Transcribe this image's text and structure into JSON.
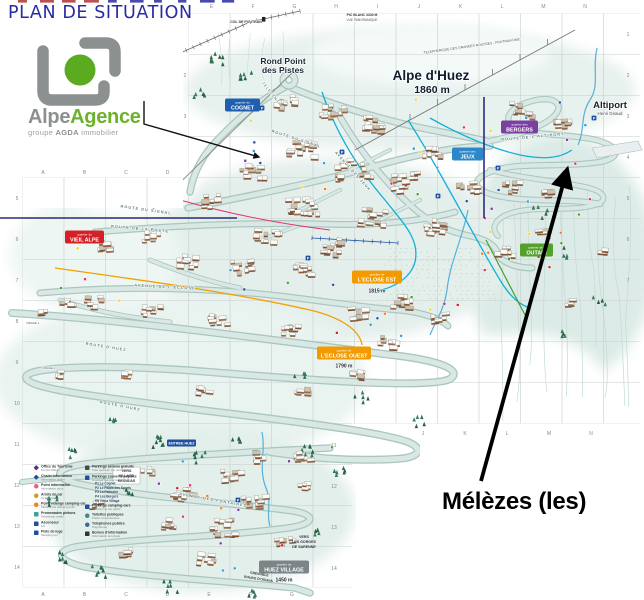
{
  "title": "PLAN DE SITUATION",
  "logo": {
    "brand_gray": "Alpe",
    "brand_green": "Agence",
    "sub_1": "groupe ",
    "sub_2": "AGDA",
    "sub_3": " immobilier"
  },
  "callout": {
    "label": "Mélèzes (les)"
  },
  "resort": {
    "name": "Alpe d'Huez",
    "altitude": "1860 m",
    "rond_point_line1": "Rond Point",
    "rond_point_line2": "des Pistes",
    "altiport": "Altiport",
    "altiport_sub": "Henri Giraud"
  },
  "quartiers": {
    "cognet": {
      "prefix": "quartier du",
      "name": "COGNET",
      "color": "#1f5fae"
    },
    "jeux": {
      "prefix": "quartier des",
      "name": "JEUX",
      "color": "#2b87c8"
    },
    "bergers": {
      "prefix": "quartier des",
      "name": "BERGERS",
      "color": "#7b3fa0"
    },
    "vieil_alpe": {
      "prefix": "quartier du",
      "name": "VIEIL ALPE",
      "color": "#d42027"
    },
    "outari": {
      "prefix": "quartier de l'",
      "name": "OUTARI",
      "color": "#55a02c"
    },
    "eclose_est": {
      "prefix": "quartier de",
      "name": "L'ECLOSE EST",
      "color": "#f29a00",
      "altitude": "1815 m"
    },
    "eclose_ouest": {
      "prefix": "quartier de",
      "name": "L'ECLOSE OUEST",
      "color": "#f29a00",
      "altitude": "1790 m"
    },
    "huez_village": {
      "prefix": "quartier de",
      "name": "HUEZ VILLAGE",
      "color": "#7d8487",
      "altitude": "1450 m"
    }
  },
  "places": {
    "col_de_poutran": "COL DE POUTRAN",
    "pic_blanc_line1": "PIC BLANC 3330 M",
    "pic_blanc_line2": "VUE PANORAMIQUE",
    "dmc": "TELEPHERIQUE DES GRANDES ROUSSES - POUTRAN DMC",
    "telecentre": "TELECENTRE",
    "vers_villard_1": "VERS",
    "vers_villard_2": "VILLARD",
    "vers_villard_3": "RECULAS",
    "vers_gorges_1": "VERS",
    "vers_gorges_2": "LES GORGES",
    "vers_gorges_3": "DE SARENNE",
    "grenoble_1": "GRENOBLE",
    "grenoble_2": "BOURG D'OISANS",
    "entree_huez": "ENTREE HUEZ",
    "virage_1": "VIRAGE 1",
    "virage_2": "VIRAGE 2"
  },
  "roads": {
    "signal": "ROUTE DU SIGNAL",
    "signal2": "ROUTE DU SIGNAL",
    "poste": "ROUTE DE LA POSTE",
    "eclose": "AVENUE DE L'ECLOSE",
    "huez1": "ROUTE D'HUEZ",
    "huez2": "ROUTE D'HUEZ",
    "jeux": "AVENUE DES JEUX",
    "altiport": "ROUTE DE L'ALTIPORT",
    "fontaines": "AVENUE DES FONTAINES"
  },
  "icons": {
    "parking": "P"
  },
  "grid": {
    "top_letters": [
      "E",
      "F",
      "G",
      "H",
      "I",
      "J",
      "K",
      "L",
      "M",
      "N"
    ],
    "mid_letters": [
      "A",
      "B",
      "C",
      "D"
    ],
    "bottom_letters": [
      "A",
      "B",
      "C",
      "D",
      "E",
      "F",
      "G"
    ],
    "bottom_right_letters": [
      "J",
      "K",
      "L",
      "M",
      "N"
    ],
    "right_numbers": [
      "1",
      "2",
      "3",
      "4",
      "5",
      "6",
      "7"
    ],
    "left_numbers": [
      "5",
      "6",
      "7",
      "8",
      "9",
      "10",
      "11",
      "12",
      "13",
      "14"
    ],
    "inner_left_numbers": [
      "2",
      "3"
    ],
    "inner_right_numbers": [
      "11",
      "12",
      "13",
      "14"
    ]
  },
  "legend": {
    "left": [
      {
        "fr": "Office du Tourisme",
        "en": "Tourist Office",
        "color": "#5a2d82",
        "shape": "diamond"
      },
      {
        "fr": "Chalet Information",
        "en": "Information chalet",
        "color": "#1f4fa0",
        "shape": "diamond"
      },
      {
        "fr": "Point Information",
        "en": "Information point",
        "color": "#e8608a",
        "shape": "circle"
      },
      {
        "fr": "Arrêts de car",
        "en": "Coach stops",
        "color": "#c8a020",
        "shape": "circle"
      },
      {
        "fr": "Point vidange camping-car",
        "en": "Motorhome draining point",
        "color": "#f08020",
        "shape": "circle"
      },
      {
        "fr": "Promenades piétons",
        "en": "Pedestrian walks",
        "color": "#3fa0a0",
        "shape": "square"
      },
      {
        "fr": "Ascenseur",
        "en": "Lift",
        "color": "#1f4fa0",
        "shape": "square"
      },
      {
        "fr": "Piste de luge",
        "en": "Sledging run",
        "color": "#1f4fa0",
        "shape": "square"
      }
    ],
    "right": [
      {
        "fr": "Parkings aériens gratuits",
        "en": "Free open-air car parks",
        "color": "#444c52",
        "shape": "square"
      },
      {
        "fr": "Parkings couverts payants",
        "en": "Covered fee-paying car parks",
        "color": "#1f4fa0",
        "shape": "square"
      },
      {
        "fr": "Parkings camping-cars",
        "en": "Motorhome car parks",
        "color": "#1f4fa0",
        "shape": "square"
      },
      {
        "fr": "Toilettes publiques",
        "en": "Public conveniences",
        "color": "#3f8a8a",
        "shape": "circle"
      },
      {
        "fr": "Téléphones publics",
        "en": "Payphones",
        "color": "#3f6aa0",
        "shape": "circle"
      },
      {
        "fr": "Bornes d'information",
        "en": "Information terminals",
        "color": "#333333",
        "shape": "square"
      }
    ],
    "parkings": [
      "P1 Le Cognet",
      "P2 Le Palais des Sports",
      "P3 La Patinoire",
      "P4 Les Bergers",
      "P5 Vieux Village"
    ]
  }
}
